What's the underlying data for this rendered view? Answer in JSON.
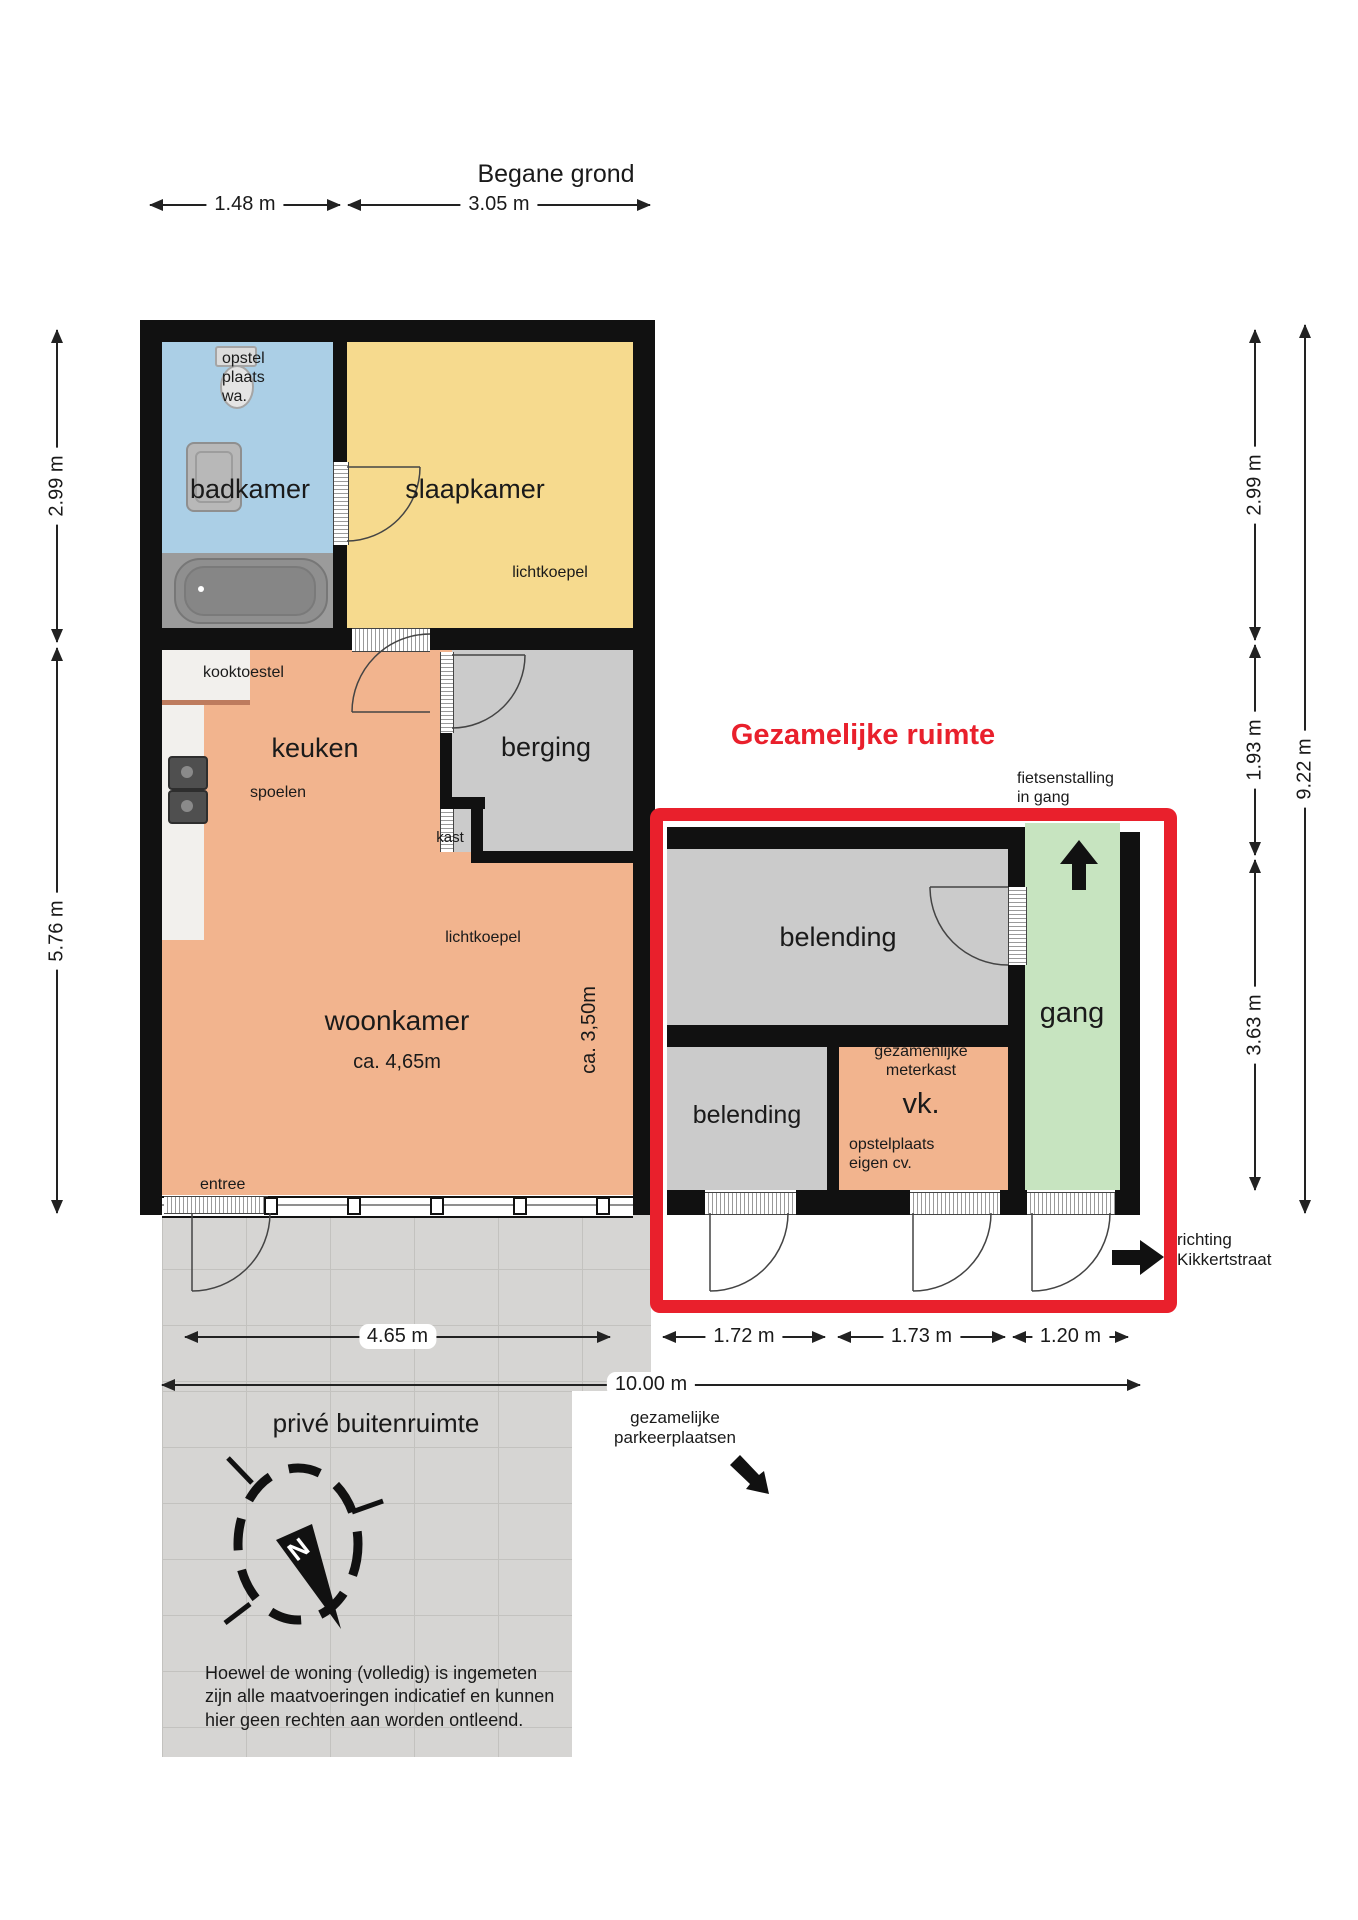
{
  "page": {
    "title": "Begane grond"
  },
  "colors": {
    "wall": "#111111",
    "badkamer": "#abcfe6",
    "slaapkamer": "#f6da8e",
    "keuken_woonkamer": "#f2b48e",
    "berging_belending": "#cbcbcb",
    "gang": "#c7e4c0",
    "vk": "#f2b48e",
    "patio_tiles": "#d6d5d3",
    "annotation_red": "#e9202c"
  },
  "rooms": {
    "badkamer": {
      "label": "badkamer",
      "fixture_note": "opstel\nplaats\nwa."
    },
    "slaapkamer": {
      "label": "slaapkamer",
      "skylight": "lichtkoepel"
    },
    "keuken": {
      "label": "keuken",
      "cooktop": "kooktoestel",
      "sink": "spoelen"
    },
    "berging": {
      "label": "berging",
      "closet": "kast"
    },
    "woonkamer": {
      "label": "woonkamer",
      "width_note": "ca. 4,65m",
      "depth_note": "ca. 3,50m",
      "skylight": "lichtkoepel",
      "entrance": "entree"
    }
  },
  "shared_area": {
    "heading": "Gezamelijke ruimte",
    "belending_upper": "belending",
    "belending_lower": "belending",
    "gang": "gang",
    "vk": "vk.",
    "meterkast_note": "gezamenlijke\nmeterkast",
    "cv_note": "opstelplaats\neigen cv.",
    "bike_note": "fietsenstalling\nin gang",
    "street_note": "richting\nKikkertstraat",
    "parking_note": "gezamelijke\nparkeerplaatsen"
  },
  "outdoor": {
    "patio_label": "privé buitenruimte",
    "compass_letter": "N",
    "disclaimer": "Hoewel de woning (volledig) is ingemeten\nzijn alle maatvoeringen indicatief en kunnen\nhier geen rechten aan worden ontleend."
  },
  "dimensions": {
    "top_badkamer": "1.48 m",
    "top_slaapkamer": "3.05 m",
    "left_badkamer": "2.99 m",
    "left_woonkamer": "5.76 m",
    "right_slaapkamer": "2.99 m",
    "right_berging": "1.93 m",
    "right_lower": "3.63 m",
    "right_total": "9.22 m",
    "bottom_woonkamer": "4.65 m",
    "bottom_belending": "1.72 m",
    "bottom_vk": "1.73 m",
    "bottom_gang": "1.20 m",
    "bottom_total": "10.00 m"
  }
}
